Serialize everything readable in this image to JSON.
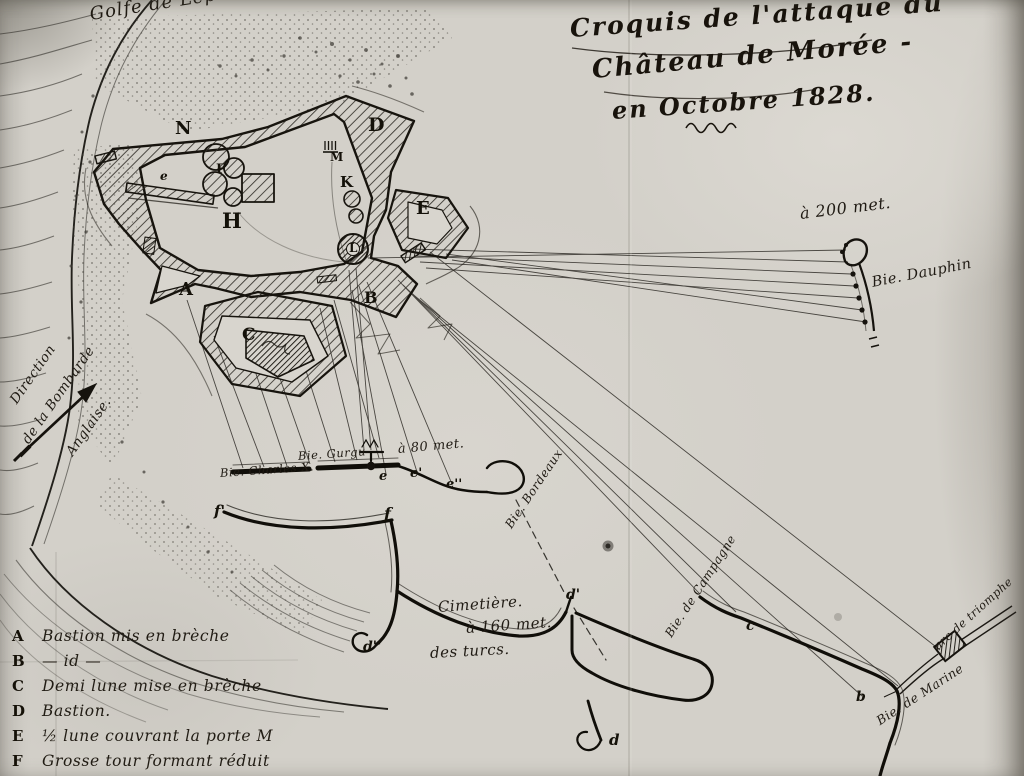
{
  "title": {
    "line1": "Croquis de l'attaque du",
    "line2": "Château de Morée -",
    "line3": "en Octobre 1828."
  },
  "sea_label": "Golfe de Lépante.",
  "direction_note": {
    "line1": "Direction",
    "line2": "de la Bombarde",
    "line3": "Anglaise."
  },
  "map_labels": {
    "battery_charles": "Bie. Charles X.",
    "battery_gurgu": "Bie. Gurgu",
    "dist_80": "à 80 met.",
    "battery_bordeaux": "Bie. Bordeaux",
    "battery_dauphin": "Bie. Dauphin",
    "dist_200": "à 200 met.",
    "battery_campagne": "Bie. de Campagne",
    "battery_marine": "Bie. de Marine",
    "arc_triomphe": "arc de triomphe",
    "cemetery_line1": "Cimetière.",
    "cemetery_line2": "à 160 met.",
    "cemetery_line3": "des turcs."
  },
  "legend": {
    "items": [
      {
        "letter": "A",
        "text": "Bastion mis en brèche"
      },
      {
        "letter": "B",
        "text": "— id —"
      },
      {
        "letter": "C",
        "text": "Demi lune mise en brèche"
      },
      {
        "letter": "D",
        "text": "Bastion."
      },
      {
        "letter": "E",
        "text": "½ lune couvrant la porte M"
      },
      {
        "letter": "F",
        "text": "Grosse tour formant réduit"
      }
    ]
  },
  "map_letters": {
    "fort": [
      {
        "t": "N",
        "x": 175,
        "y": 120,
        "s": 18
      },
      {
        "t": "D",
        "x": 368,
        "y": 116,
        "s": 19
      },
      {
        "t": "M",
        "x": 330,
        "y": 151,
        "s": 12
      },
      {
        "t": "K",
        "x": 340,
        "y": 175,
        "s": 15
      },
      {
        "t": "E",
        "x": 416,
        "y": 200,
        "s": 18
      },
      {
        "t": "L",
        "x": 349,
        "y": 242,
        "s": 12
      },
      {
        "t": "F",
        "x": 216,
        "y": 163,
        "s": 13
      },
      {
        "t": "H",
        "x": 222,
        "y": 210,
        "s": 21
      },
      {
        "t": "A",
        "x": 179,
        "y": 281,
        "s": 18
      },
      {
        "t": "B",
        "x": 364,
        "y": 290,
        "s": 16
      },
      {
        "t": "C",
        "x": 242,
        "y": 327,
        "s": 17
      },
      {
        "t": "e",
        "x": 160,
        "y": 170,
        "s": 12,
        "i": 1
      }
    ],
    "points": [
      {
        "t": "f'",
        "x": 214,
        "y": 504,
        "s": 15,
        "i": 1
      },
      {
        "t": "f",
        "x": 384,
        "y": 506,
        "s": 16,
        "i": 1
      },
      {
        "t": "e",
        "x": 379,
        "y": 470,
        "s": 13,
        "i": 1
      },
      {
        "t": "e'",
        "x": 410,
        "y": 467,
        "s": 13,
        "i": 1
      },
      {
        "t": "e''",
        "x": 446,
        "y": 478,
        "s": 13,
        "i": 1
      },
      {
        "t": "d''",
        "x": 363,
        "y": 640,
        "s": 14,
        "i": 1
      },
      {
        "t": "d'",
        "x": 566,
        "y": 588,
        "s": 14,
        "i": 1
      },
      {
        "t": "d",
        "x": 609,
        "y": 733,
        "s": 15,
        "i": 1
      },
      {
        "t": "c",
        "x": 746,
        "y": 619,
        "s": 14,
        "i": 1
      },
      {
        "t": "b",
        "x": 856,
        "y": 690,
        "s": 14,
        "i": 1
      }
    ]
  }
}
